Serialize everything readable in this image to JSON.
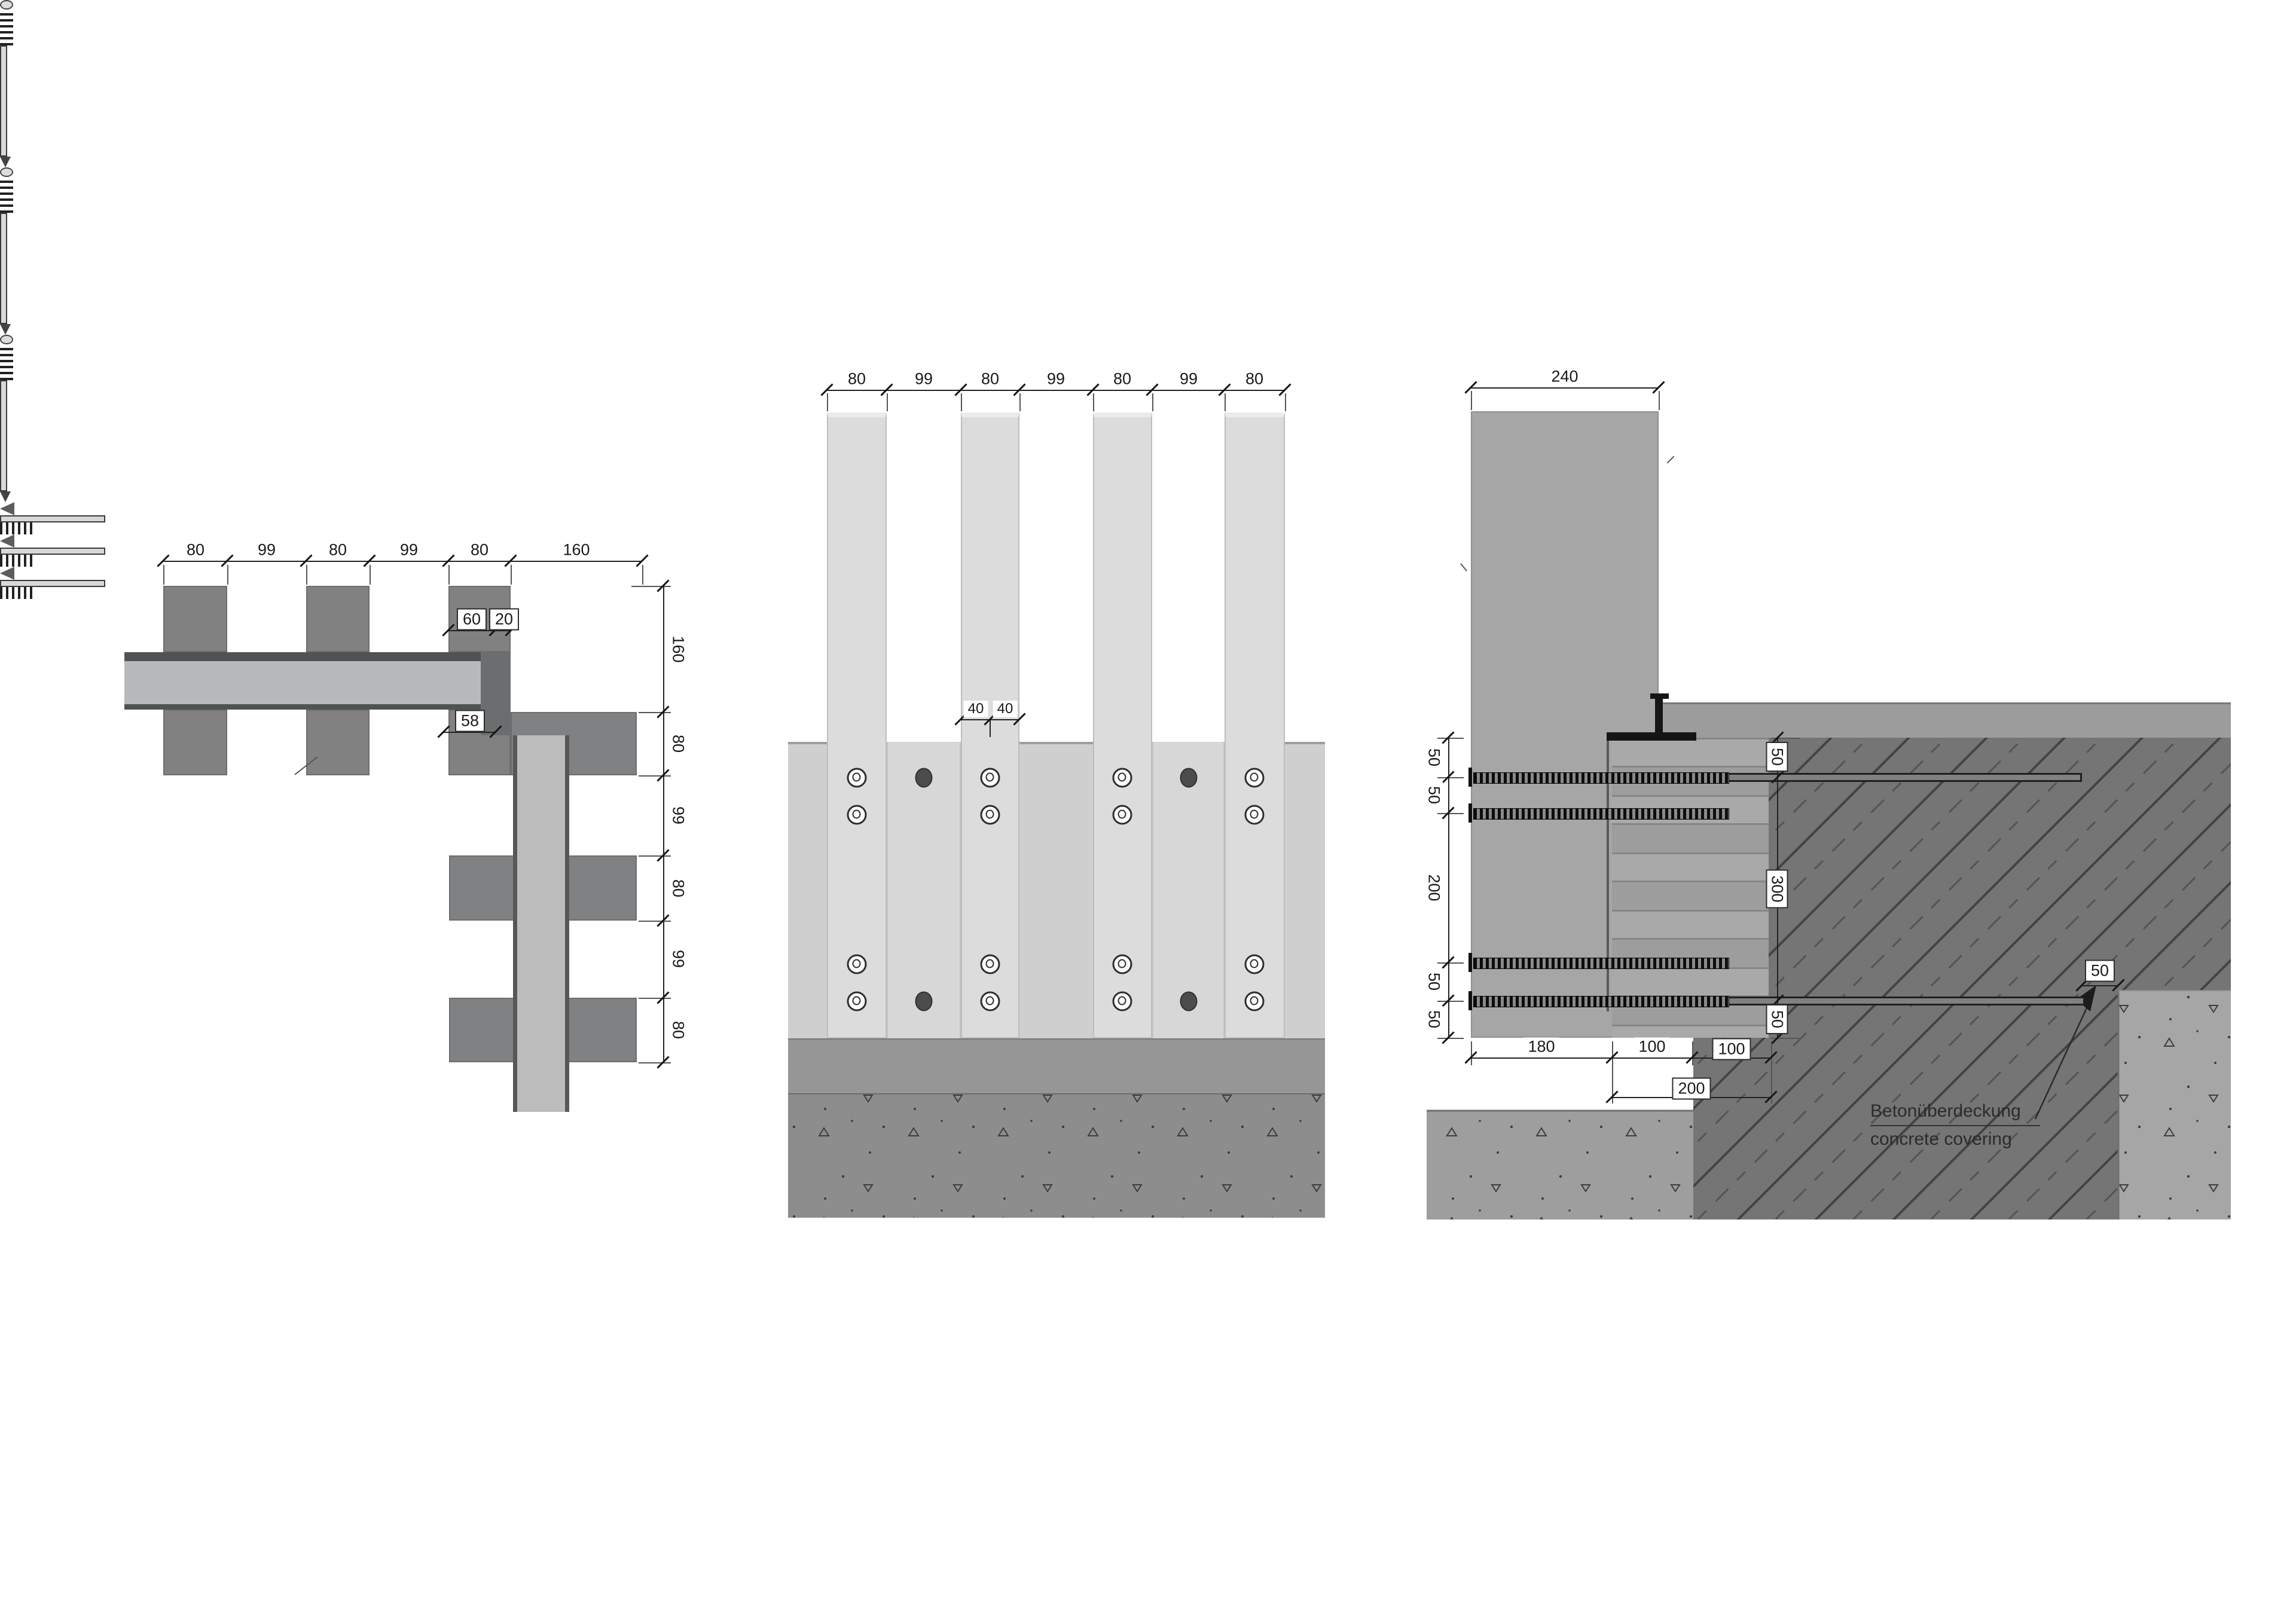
{
  "drawing": {
    "left_view": {
      "top_dims": [
        "80",
        "99",
        "80",
        "99",
        "80",
        "160"
      ],
      "side_dims": [
        "160",
        "80",
        "99",
        "80",
        "99",
        "80"
      ],
      "offset_dims": [
        "60",
        "20"
      ],
      "edge_dim": "58"
    },
    "front_view": {
      "top_dims": [
        "80",
        "99",
        "80",
        "99",
        "80",
        "99",
        "80"
      ],
      "slat_dims": [
        "40",
        "40"
      ]
    },
    "section_view": {
      "top_dim": "240",
      "side_dims": [
        "50",
        "50",
        "200",
        "50",
        "50"
      ],
      "anchor_dims": [
        "50",
        "300",
        "50"
      ],
      "bottom_dims": [
        "180",
        "100"
      ],
      "bottom_boxed_dims": [
        "100",
        "200"
      ],
      "cover_dim": "50",
      "annotation": {
        "line1": "Betonüberdeckung",
        "line2": "concrete covering"
      }
    },
    "colors": {
      "timber_light": "#dcdcdc",
      "timber_mid": "#b7baba",
      "batten_dark": "#818181",
      "concrete_hatch": "#757575",
      "concrete_speckle": "#9e9e9e",
      "steel_black": "#151515"
    }
  }
}
